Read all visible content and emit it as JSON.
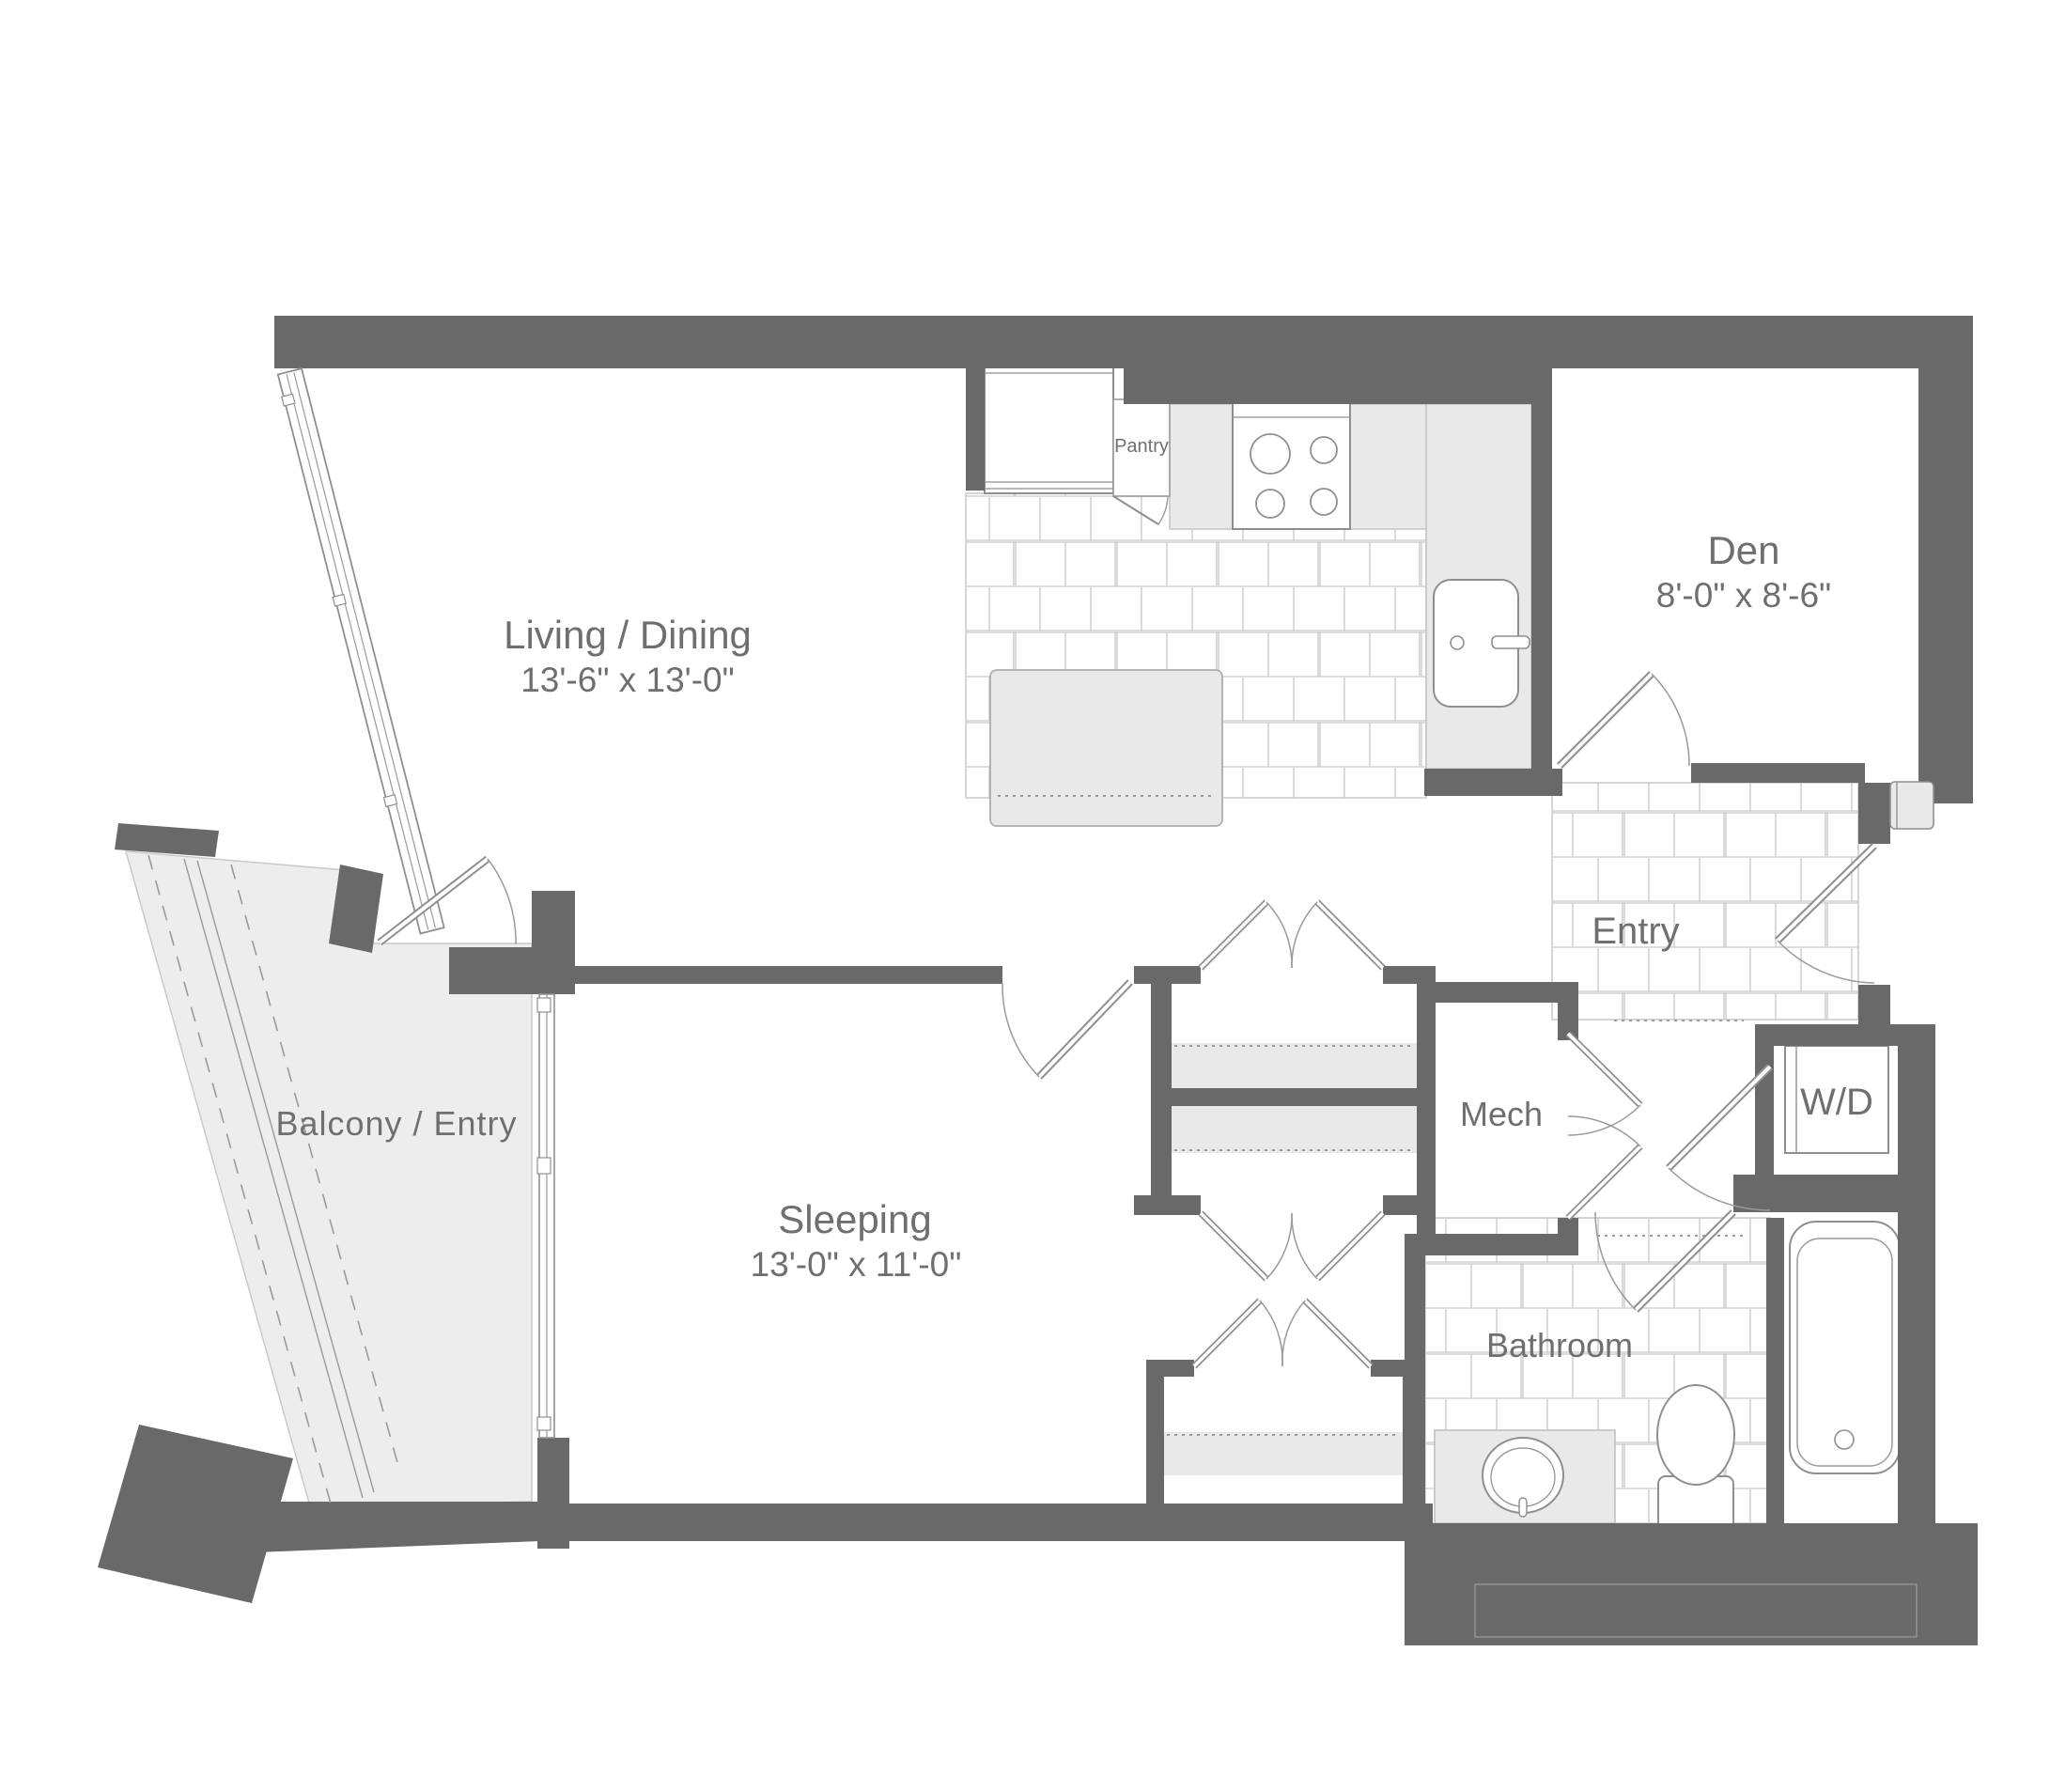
{
  "title": "Apartment floor plan",
  "rooms": {
    "living": {
      "label": "Living / Dining",
      "dims": "13'-6\" x 13'-0\""
    },
    "den": {
      "label": "Den",
      "dims": "8'-0\" x 8'-6\""
    },
    "sleeping": {
      "label": "Sleeping",
      "dims": "13'-0\" x 11'-0\""
    },
    "balcony": {
      "label": "Balcony / Entry"
    },
    "entry": {
      "label": "Entry"
    },
    "mech": {
      "label": "Mech"
    },
    "laundry": {
      "label": "W/D"
    },
    "bathroom": {
      "label": "Bathroom"
    },
    "pantry": {
      "label": "Pantry"
    }
  },
  "colors": {
    "wall": "#696969",
    "fixture_fill": "#e9e9e9",
    "outline": "#8f8f8f",
    "tile_line": "#d2d2d2",
    "label_text": "#6f6f6f",
    "background": "#ffffff"
  }
}
